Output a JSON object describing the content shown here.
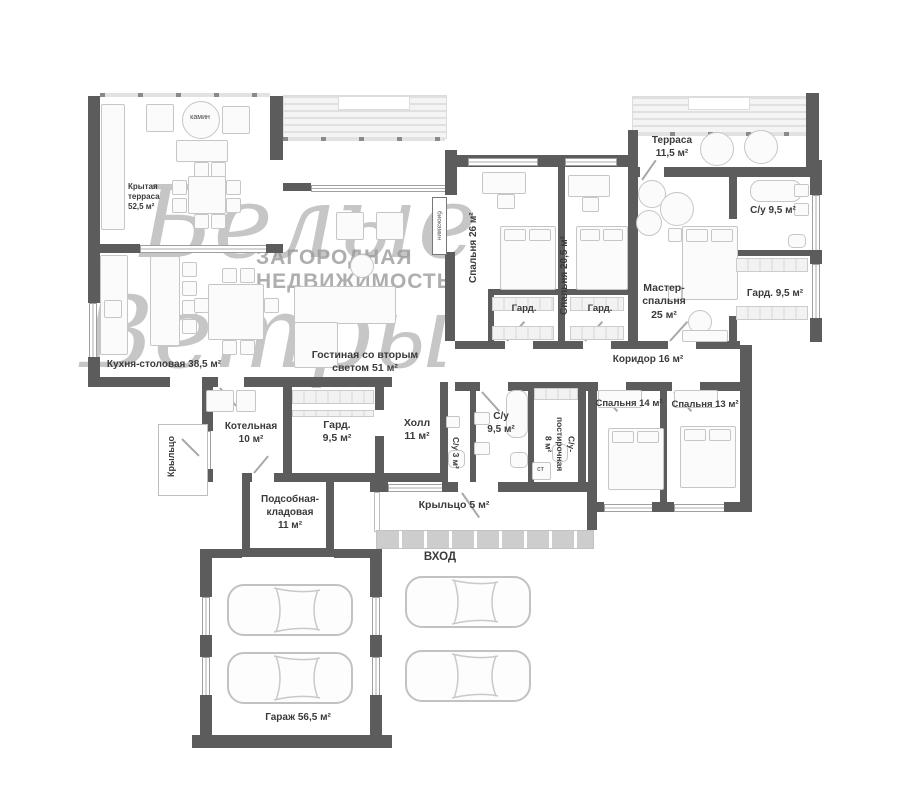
{
  "watermark": {
    "logo_line1": "Белые",
    "logo_line2": "Ветры",
    "tagline": "ЗАГОРОДНАЯ\nНЕДВИЖИМОСТЬ"
  },
  "rooms": {
    "covered_terrace": "Крытая\nтерраса\n52,5 м²",
    "fireplace": "камин",
    "kitchen": "Кухня-столовая 38,5 м²",
    "living": "Гостиная со вторым\nсветом 51 м²",
    "biofireplace": "биокамин",
    "bedroom26": "Спальня 26 м²",
    "bedroom205": "Спальня 20,5 м²",
    "ward26": "Гард.",
    "ward205": "Гард.",
    "terrace115": "Терраса\n11,5 м²",
    "master": "Мастер-\nспальня\n25 м²",
    "master_bath": "С/у 9,5 м²",
    "master_ward": "Гард. 9,5 м²",
    "corridor": "Коридор 16 м²",
    "bedroom14": "Спальня 14 м²",
    "bedroom13": "Спальня 13 м²",
    "hall": "Холл\n11 м²",
    "hall_ward": "Гард.\n9,5 м²",
    "wc3": "С/у 3 м²",
    "wc95": "С/у\n9,5 м²",
    "laundry": "С/у-\nпостирочная\n8 м²",
    "washer": "ст",
    "boiler": "Котельная\n10 м²",
    "porch_left": "Крыльцо",
    "storage": "Подсобная-\nкладовая\n11  м²",
    "porch5": "Крыльцо 5 м²",
    "entrance": "ВХОД",
    "garage": "Гараж 56,5 м²"
  }
}
